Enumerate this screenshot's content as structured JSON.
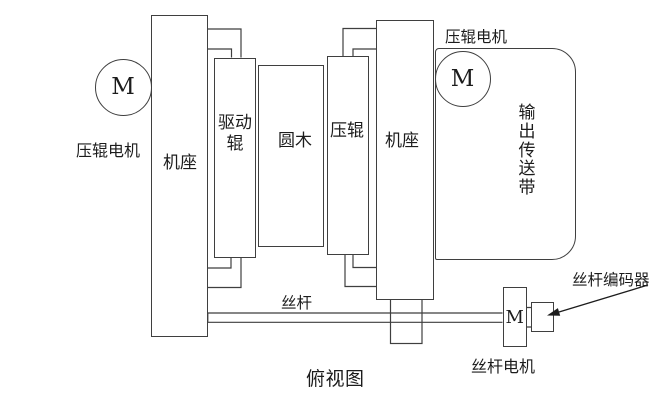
{
  "labels": {
    "press_roller_motor_left": "压辊电机",
    "base_left": "机座",
    "drive_roller": "驱动辊",
    "log": "圆木",
    "press_roller": "压辊",
    "base_right": "机座",
    "press_roller_motor_top": "压辊电机",
    "output_conveyor": "输出传送带",
    "lead_screw": "丝杆",
    "lead_screw_encoder": "丝杆编码器",
    "lead_screw_motor": "丝杆电机",
    "motor_symbol": "M",
    "caption": "俯视图"
  },
  "colors": {
    "line": "#3f3f3f",
    "text": "#1c1c1c",
    "background": "#ffffff"
  }
}
